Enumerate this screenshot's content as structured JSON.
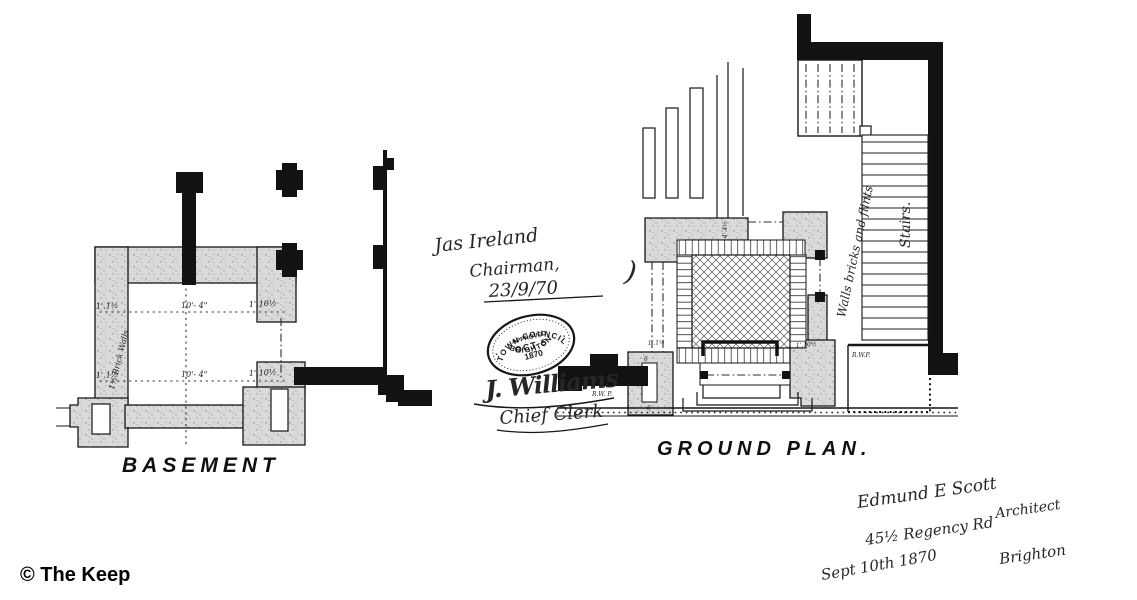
{
  "document": {
    "background": "#ffffff",
    "ink": "#121212",
    "copyright": "© The Keep"
  },
  "basement": {
    "label": "BASEMENT",
    "wall_note": "1½ Brick Walls",
    "dim_upper": {
      "left": "1'.1½",
      "center": "10'- 4\"",
      "right": "1'.10½"
    },
    "dim_lower": {
      "left": "1'.1½",
      "center": "10'- 4\"",
      "right": "1'.10½"
    }
  },
  "ground_plan": {
    "label": "GROUND PLAN.",
    "wall_note": "Walls bricks and flints",
    "stairs_label": "Stairs.",
    "rwp_left": "R.W. P.",
    "rwp_right": "R.W.P.",
    "dim_left": "1'.1½",
    "dim_right": "1'.10½",
    "dim_top": "4'.4½",
    "niche_mark": "6"
  },
  "approval": {
    "chairman_name": "Jas Ireland",
    "chairman_title": "Chairman,",
    "approval_date": "23/9/70",
    "bracket": ")",
    "stamp": {
      "arc_top": "TOWN COUNCIL",
      "line_approved": "APPROVED",
      "line_date": "OCT 5",
      "line_year": "1870",
      "arc_bottom": "BRIGHTON",
      "dot": "·"
    },
    "clerk_signature": "J. Williams",
    "clerk_title": "Chief Clerk"
  },
  "architect": {
    "name": "Edmund E Scott",
    "title": "Architect",
    "address_line1": "45½ Regency Rd",
    "address_line2": "Brighton",
    "date": "Sept 10th 1870"
  }
}
